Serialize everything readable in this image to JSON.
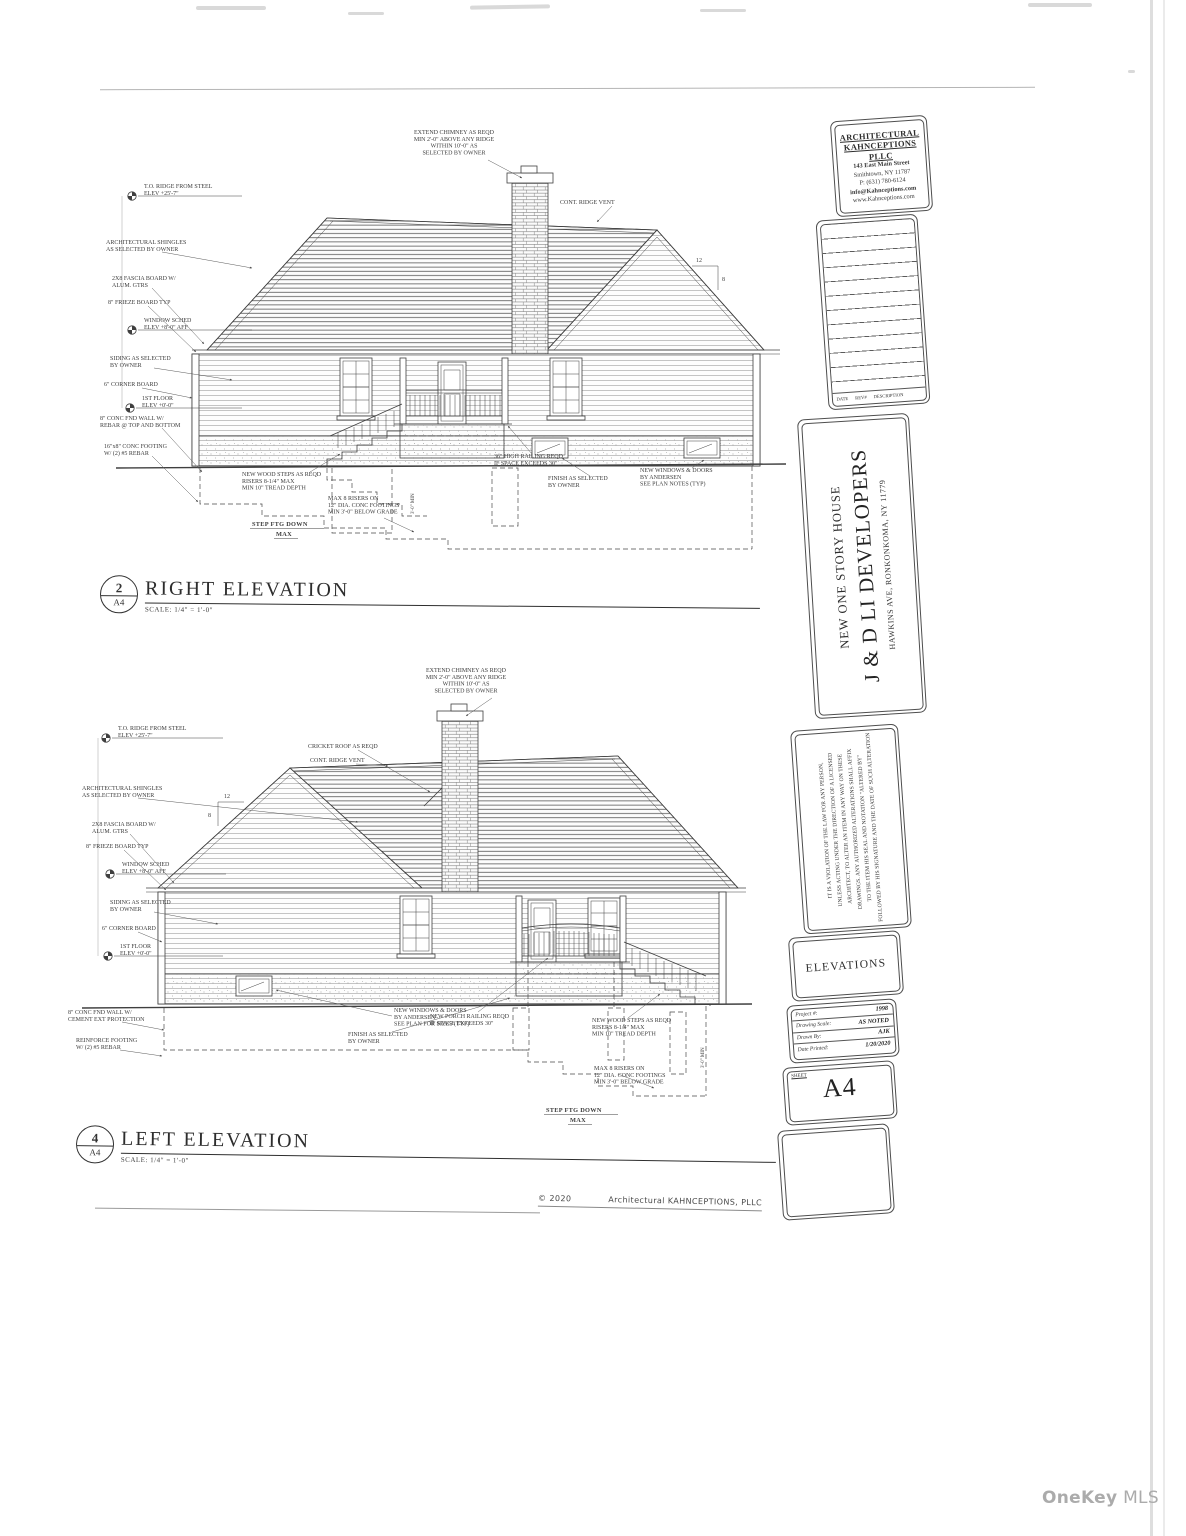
{
  "page": {
    "watermark_name": "OneKey",
    "watermark_suffix": "MLS",
    "copyright_year": "© 2020",
    "copyright_firm": "Architectural  KAHNCEPTIONS,  PLLC"
  },
  "title_block": {
    "firm": {
      "line1": "ARCHITECTURAL",
      "line2": "KAHNCEPTIONS PLLC",
      "address1": "143 East Main Street",
      "address2": "Smithtown, NY 11787",
      "phone": "P: (631) 780-6124",
      "email": "info@Kahnceptions.com",
      "web": "www.Kahnceptions.com"
    },
    "revisions": {
      "date": "DATE",
      "rev": "REV#",
      "description": "DESCRIPTION"
    },
    "project": {
      "subtitle": "NEW ONE STORY HOUSE",
      "client": "J & D LI DEVELOPERS",
      "address": "HAWKINS AVE, RONKONKOMA, NY 11779"
    },
    "disclaimer": "IT IS A VIOLATION OF THE LAW FOR ANY PERSON,\nUNLESS ACTING UNDER THE DIRECTION OF A LICENSED\nARCHITECT, TO ALTER AN ITEM IN ANY WAY ON THESE\nDRAWINGS. ANY AUTHORIZED ALTERATIONS SHALL AFFIX\nTO THE ITEM HIS SEAL AND NOTATION \"ALTERED BY\"\nFOLLOWED BY HIS SIGNATURE AND THE DATE OF SUCH ALTERATION",
    "sheet_title": "ELEVATIONS",
    "info": {
      "project_label": "Project #:",
      "project_value": "1998",
      "scale_label": "Drawing Scale:",
      "scale_value": "AS NOTED",
      "drawn_label": "Drawn By:",
      "drawn_value": "AJK",
      "printed_label": "Date Printed:",
      "printed_value": "1/20/2020"
    },
    "sheet_label": "SHEET",
    "sheet_number": "A4"
  },
  "drawings": {
    "right": {
      "num": "2",
      "sheet_ref": "A4",
      "title": "RIGHT ELEVATION",
      "scale": "SCALE: 1/4\" = 1'-0\"",
      "ann": {
        "ridge_datum": "T.O. RIDGE FROM STEEL\nELEV +25'-7\"",
        "shingles": "ARCHITECTURAL SHINGLES\nAS SELECTED BY OWNER",
        "fascia": "2X8 FASCIA BOARD W/\nALUM. GTRS",
        "frieze": "8\" FRIEZE BOARD TYP",
        "window_datum": "WINDOW SCHED\nELEV +8'-0\" AFF",
        "siding": "SIDING AS SELECTED\nBY OWNER",
        "corner": "6\" CORNER BOARD",
        "floor_datum": "1ST FLOOR\nELEV +0'-0\"",
        "fnd_wall": "8\" CONC FND WALL W/\nREBAR @ TOP AND BOTTOM",
        "footing": "16\"x8\" CONC FOOTING\nW/ (2) #5 REBAR",
        "chimney": "EXTEND CHIMNEY AS REQD\nMIN 2'-0\" ABOVE ANY RIDGE\nWITHIN 10'-0\" AS\nSELECTED BY OWNER",
        "ridge_vent": "CONT. RIDGE VENT",
        "steps": "NEW WOOD STEPS AS REQD\nRISERS 8-1/4\" MAX\nMIN 10\" TREAD DEPTH",
        "piers": "MAX 8 RISERS ON\n12\" DIA. CONC FOOTINGS\nMIN 3'-0\" BELOW GRADE",
        "step_ftg": "STEP FTG DOWN",
        "step_ftg2": "MAX",
        "railing": "36\" HIGH RAILING REQD\nIF SPACE EXCEEDS 30\"",
        "finish": "FINISH AS SELECTED\nBY OWNER",
        "windows": "NEW WINDOWS & DOORS\nBY ANDERSEN\nSEE PLAN NOTES (TYP)",
        "pitch_rise": "12",
        "pitch_run": "8",
        "min_depth": "3'-0\" MIN"
      }
    },
    "left": {
      "num": "4",
      "sheet_ref": "A4",
      "title": "LEFT ELEVATION",
      "scale": "SCALE: 1/4\" = 1'-0\"",
      "ann": {
        "ridge_datum": "T.O. RIDGE FROM STEEL\nELEV +25'-7\"",
        "shingles": "ARCHITECTURAL SHINGLES\nAS SELECTED BY OWNER",
        "fascia": "2X8 FASCIA BOARD W/\nALUM. GTRS",
        "frieze": "8\" FRIEZE BOARD TYP",
        "window_datum": "WINDOW SCHED\nELEV +8'-0\" AFF",
        "siding": "SIDING AS SELECTED\nBY OWNER",
        "corner": "6\" CORNER BOARD",
        "floor_datum": "1ST FLOOR\nELEV +0'-0\"",
        "fnd_wall": "8\" CONC FND WALL W/\nCEMENT EXT PROTECTION",
        "footing": "REINFORCE FOOTING\nW/ (2) #5 REBAR",
        "chimney": "EXTEND CHIMNEY AS REQD\nMIN 2'-0\" ABOVE ANY RIDGE\nWITHIN 10'-0\" AS\nSELECTED BY OWNER",
        "cricket": "CRICKET ROOF AS REQD",
        "ridge_vent": "CONT. RIDGE VENT",
        "bsmt_window": "NEW WINDOWS & DOORS\nBY ANDERSEN\nSEE PLAN FOR SIZES (TYP)",
        "finish": "FINISH AS SELECTED\nBY OWNER",
        "railing": "NEW PORCH RAILING REQD\nIF SPACE EXCEEDS 30\"",
        "steps": "NEW WOOD STEPS AS REQD\nRISERS 8-1/4\" MAX\nMIN 10\" TREAD DEPTH",
        "piers": "MAX 8 RISERS ON\n12\" DIA. CONC FOOTINGS\nMIN 3'-0\" BELOW GRADE",
        "step_ftg": "STEP FTG DOWN",
        "step_ftg2": "MAX",
        "pitch_rise": "12",
        "pitch_run": "8",
        "min_depth": "3'-0\" MIN"
      }
    }
  }
}
